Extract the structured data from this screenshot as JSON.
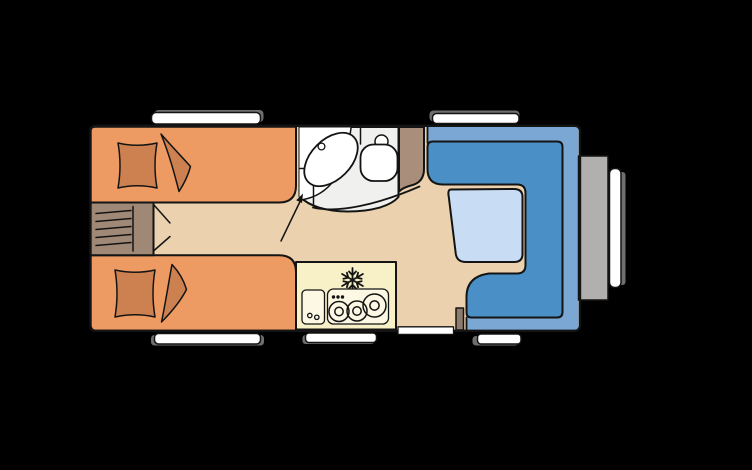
{
  "page": {
    "title": "Caravan floor plan",
    "background": "#000000"
  },
  "colors": {
    "background": "#000000",
    "floor": "#EBD1AE",
    "outline": "#141414",
    "bed": "#ED9B62",
    "bedding": "#CD8150",
    "ladder_box": "#9F8875",
    "wardrobe": "#A98E7B",
    "bathroom_floor": "#F0F0EE",
    "fixture_white": "#FFFFFF",
    "kitchen": "#F8F1C7",
    "kitchen_unit": "#FCF8E3",
    "dinette_base": "#7AA7D4",
    "dinette_cushion": "#4A90C6",
    "table": "#C8DCF3",
    "window_white": "#FFFFFF",
    "window_shadow": "#6F6F6F",
    "front_box": "#B2B0AE",
    "post": "#8D7B6E"
  },
  "floorplan": {
    "vehicle": "caravan",
    "areas": [
      {
        "id": "twin-bed-top",
        "type": "bed"
      },
      {
        "id": "twin-bed-bottom",
        "type": "bed"
      },
      {
        "id": "bunk-ladder-box",
        "type": "storage-steps"
      },
      {
        "id": "washroom",
        "type": "bathroom",
        "fixtures": [
          "sink",
          "toilet",
          "vanity"
        ]
      },
      {
        "id": "wardrobe",
        "type": "closet"
      },
      {
        "id": "kitchen",
        "type": "kitchenette",
        "fixtures": [
          "fridge-snowflake",
          "sink",
          "stove-3-burner"
        ]
      },
      {
        "id": "dinette",
        "type": "u-shaped-seating",
        "fixtures": [
          "table"
        ]
      },
      {
        "id": "front-storage",
        "type": "exterior-box"
      }
    ],
    "openings": {
      "windows": [
        "top-left",
        "top-right",
        "bottom-left",
        "bottom-kitchen",
        "bottom-right",
        "front-vertical"
      ],
      "doors": [
        "entry-door-bottom",
        "washroom-door-swing-arc",
        "entry-arrow-marker"
      ]
    }
  }
}
